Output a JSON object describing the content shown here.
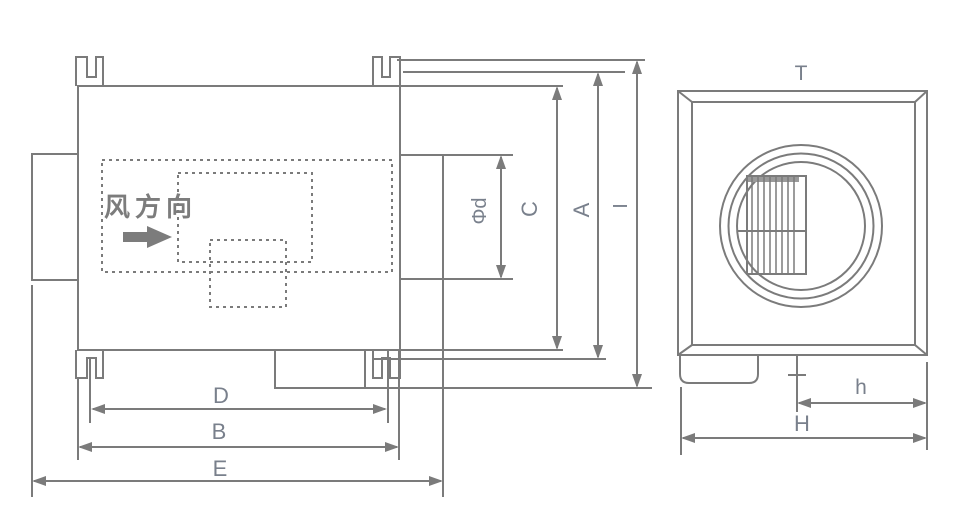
{
  "side_view": {
    "flow_direction_label": "风方向",
    "dim_phi_d": "Φd",
    "dim_c": "C",
    "dim_a": "A",
    "dim_i": "I",
    "dim_d": "D",
    "dim_b": "B",
    "dim_e": "E"
  },
  "front_view": {
    "dim_t": "T",
    "dim_h_small": "h",
    "dim_h_large": "H"
  },
  "colors": {
    "line": "#7b7b7b",
    "dim_label": "#79808c",
    "cjk_text": "#7c7c7c",
    "grille_shade": "#9a9a9a"
  }
}
